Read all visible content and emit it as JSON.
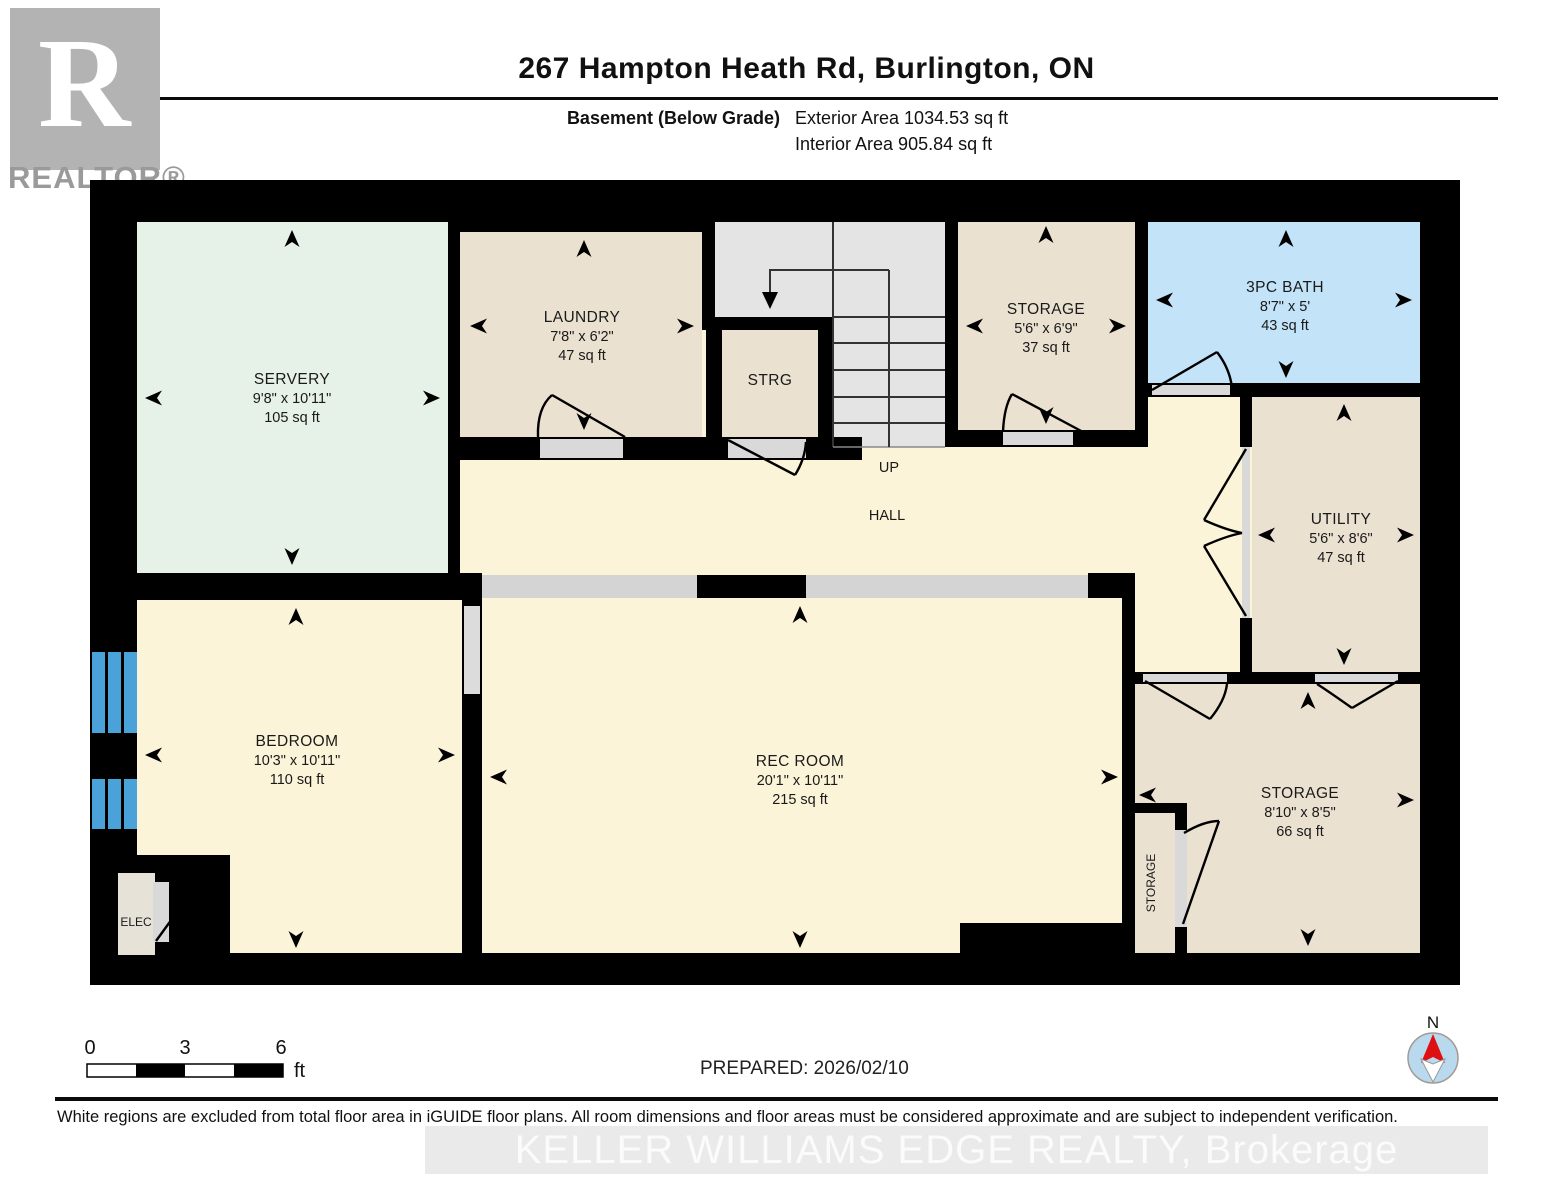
{
  "header": {
    "title": "267 Hampton Heath Rd, Burlington, ON",
    "floor_label": "Basement (Below Grade)",
    "exterior_area": "Exterior Area 1034.53 sq ft",
    "interior_area": "Interior Area 905.84 sq ft",
    "logo_letter": "R",
    "logo_text": "REALTOR®"
  },
  "rooms": {
    "servery": {
      "name": "SERVERY",
      "dims": "9'8\" x 10'11\"",
      "area": "105 sq ft"
    },
    "laundry": {
      "name": "LAUNDRY",
      "dims": "7'8\" x 6'2\"",
      "area": "47 sq ft"
    },
    "strg": {
      "name": "STRG"
    },
    "storage_top": {
      "name": "STORAGE",
      "dims": "5'6\" x 6'9\"",
      "area": "37 sq ft"
    },
    "bath": {
      "name": "3PC BATH",
      "dims": "8'7\" x 5'",
      "area": "43 sq ft"
    },
    "utility": {
      "name": "UTILITY",
      "dims": "5'6\" x 8'6\"",
      "area": "47 sq ft"
    },
    "bedroom": {
      "name": "BEDROOM",
      "dims": "10'3\" x 10'11\"",
      "area": "110 sq ft"
    },
    "rec_room": {
      "name": "REC ROOM",
      "dims": "20'1\" x 10'11\"",
      "area": "215 sq ft"
    },
    "storage_bottom": {
      "name": "STORAGE",
      "dims": "8'10\" x 8'5\"",
      "area": "66 sq ft"
    },
    "storage_closet": {
      "name": "STORAGE"
    },
    "elec": {
      "name": "ELEC"
    },
    "hall": {
      "name": "HALL"
    },
    "stairs_up": {
      "name": "UP"
    }
  },
  "scale_bar": {
    "tick0": "0",
    "tick3": "3",
    "tick6": "6",
    "unit": "ft"
  },
  "compass": {
    "north_label": "N"
  },
  "footer": {
    "prepared": "PREPARED: 2026/02/10",
    "disclaimer": "White regions are excluded from total floor area in iGUIDE floor plans. All room dimensions and floor areas must be considered approximate and are subject to independent verification.",
    "watermark": "KELLER WILLIAMS EDGE REALTY, Brokerage"
  },
  "colors": {
    "wall": "#000000",
    "room_cream": "#fcf4d8",
    "room_beige": "#eae1d1",
    "room_mint": "#e6f1e7",
    "room_blue": "#c2e3f8",
    "stair_gray": "#e4e4e4",
    "opening_gray": "#d9d9d9",
    "window_blue": "#4aa3d8",
    "compass_blue": "#b9d9ef",
    "compass_red": "#dd1111"
  }
}
